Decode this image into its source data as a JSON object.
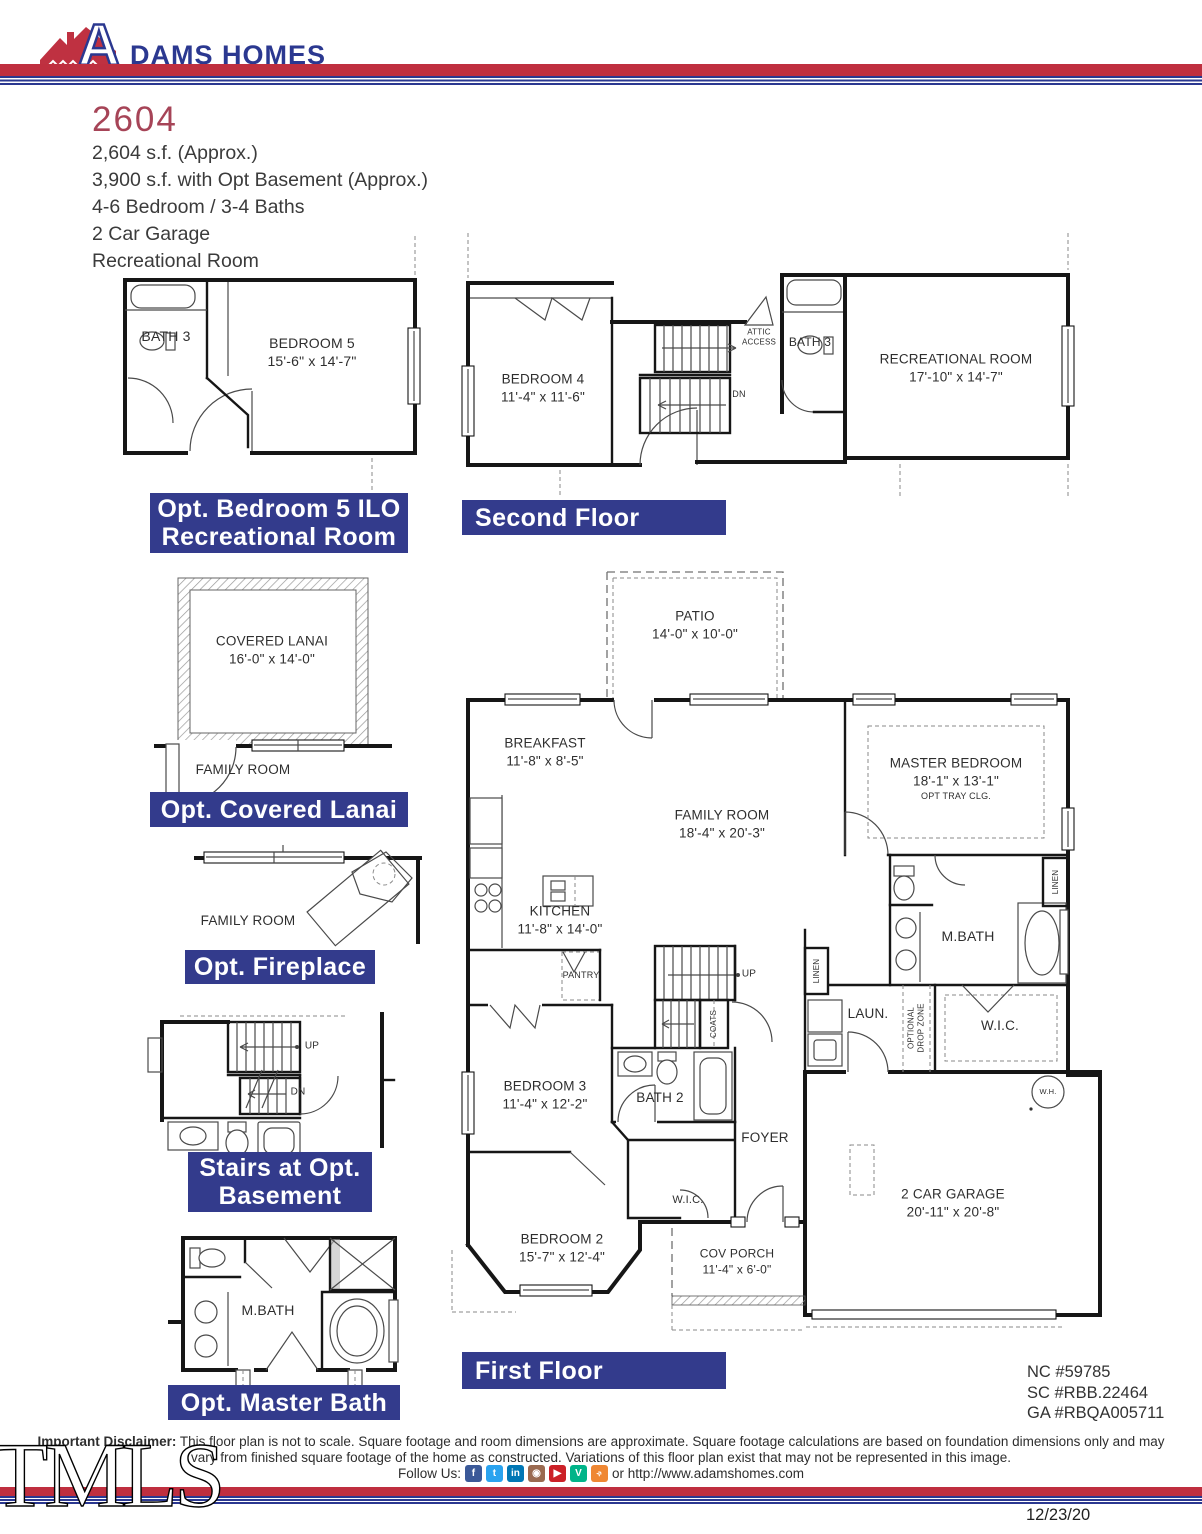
{
  "colors": {
    "banner_navy": "#333b8c",
    "brand_blue": "#2b3890",
    "brand_red": "#bf2f3f",
    "title_red": "#a64457"
  },
  "header": {
    "brand_a": "A",
    "brand_rest": "DAMS HOMES"
  },
  "plan": {
    "number": "2604",
    "specs": "2,604 s.f. (Approx.)\n3,900 s.f. with Opt Basement (Approx.)\n4-6 Bedroom / 3-4 Baths\n2 Car Garage\nRecreational Room"
  },
  "banners": {
    "opt_bedroom5": "Opt. Bedroom 5 ILO\nRecreational Room",
    "second_floor": "Second Floor",
    "opt_covered_lanai": "Opt. Covered Lanai",
    "opt_fireplace": "Opt. Fireplace",
    "stairs_basement": "Stairs at Opt.\nBasement",
    "opt_master_bath": "Opt. Master Bath",
    "first_floor": "First Floor"
  },
  "opt_bedroom5": {
    "bath3": "BATH 3",
    "bedroom5": "BEDROOM 5\n15'-6\" x 14'-7\""
  },
  "second_floor": {
    "bedroom4": "BEDROOM 4\n11'-4\" x 11'-6\"",
    "attic": "ATTIC\nACCESS",
    "bath3": "BATH 3",
    "recroom": "RECREATIONAL ROOM\n17'-10\" x 14'-7\"",
    "dn": "DN"
  },
  "lanai": {
    "covered_lanai": "COVERED LANAI\n16'-0\" x 14'-0\"",
    "family_room": "FAMILY ROOM"
  },
  "fireplace": {
    "family_room": "FAMILY ROOM"
  },
  "stairs_basement": {
    "up": "UP",
    "dn": "DN"
  },
  "opt_master_bath": {
    "mbath": "M.BATH"
  },
  "first_floor": {
    "patio": "PATIO\n14'-0\" x 10'-0\"",
    "breakfast": "BREAKFAST\n11'-8\" x 8'-5\"",
    "family_room": "FAMILY ROOM\n18'-4\" x 20'-3\"",
    "kitchen": "KITCHEN\n11'-8\" x 14'-0\"",
    "pantry": "PANTRY",
    "up": "UP",
    "coats": "COATS",
    "master_bedroom": "MASTER BEDROOM\n18'-1\" x 13'-1\"",
    "master_sub": "OPT TRAY CLG.",
    "linen": "LINEN",
    "linen2": "LINEN",
    "mbath": "M.BATH",
    "wic": "W.I.C.",
    "laun": "LAUN.",
    "drop_zone": "OPTIONAL\nDROP ZONE",
    "wh": "W.H.",
    "bedroom3": "BEDROOM 3\n11'-4\" x 12'-2\"",
    "bath2": "BATH 2",
    "foyer": "FOYER",
    "wic2": "W.I.C.",
    "bedroom2": "BEDROOM 2\n15'-7\" x 12'-4\"",
    "cov_porch": "COV PORCH\n11'-4\" x 6'-0\"",
    "garage": "2 CAR GARAGE\n20'-11\" x 20'-8\""
  },
  "footer": {
    "licenses": "NC #59785\nSC #RBB.22464\nGA #RBQA005711",
    "disclaimer_label": "Important Disclaimer:",
    "disclaimer_text": " This floor plan is not to scale. Square footage and room dimensions are approximate. Square footage calculations are based on foundation dimensions only and may vary from finished square footage of the home as constructed. Variations of this floor plan exist that may not be represented in this image.",
    "follow": "Follow Us:",
    "social": [
      {
        "name": "facebook",
        "glyph": "f"
      },
      {
        "name": "twitter",
        "glyph": "t"
      },
      {
        "name": "linkedin",
        "glyph": "in"
      },
      {
        "name": "instagram",
        "glyph": "◉"
      },
      {
        "name": "youtube",
        "glyph": "▶"
      },
      {
        "name": "vine",
        "glyph": "V"
      },
      {
        "name": "rss",
        "glyph": "»"
      }
    ],
    "url": "or http://www.adamshomes.com",
    "date": "12/23/20",
    "watermark": "TMLS"
  }
}
